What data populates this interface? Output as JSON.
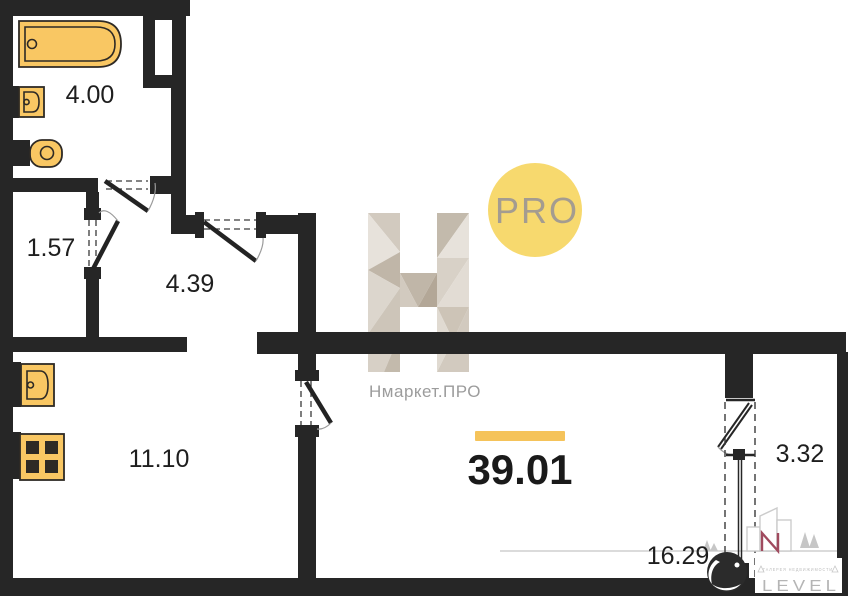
{
  "rooms": {
    "bathroom": {
      "area": "4.00"
    },
    "storage": {
      "area": "1.57"
    },
    "hallway": {
      "area": "4.39"
    },
    "kitchen": {
      "area": "11.10"
    },
    "living_room": {
      "area": "16.29"
    },
    "balcony": {
      "area": "3.32"
    }
  },
  "total_area": {
    "value": "39.01"
  },
  "watermark": {
    "brand": "Нмаркет.ПРО",
    "badge": "PRO"
  },
  "developer_logo": {
    "wordmark": "LEVEL",
    "tagline": "ГАЛЕРЕЯ НЕДВИЖИМОСТИ"
  },
  "colors": {
    "wall": "#262626",
    "fixture_fill": "#f9c763",
    "accent_bar": "#f5c35a",
    "badge_fill": "#f7d96e",
    "badge_text": "#a49c90",
    "watermark_text": "#9c9c9c",
    "logo_gray": "#c6c6c6",
    "logo_accent": "#a04a5e"
  }
}
